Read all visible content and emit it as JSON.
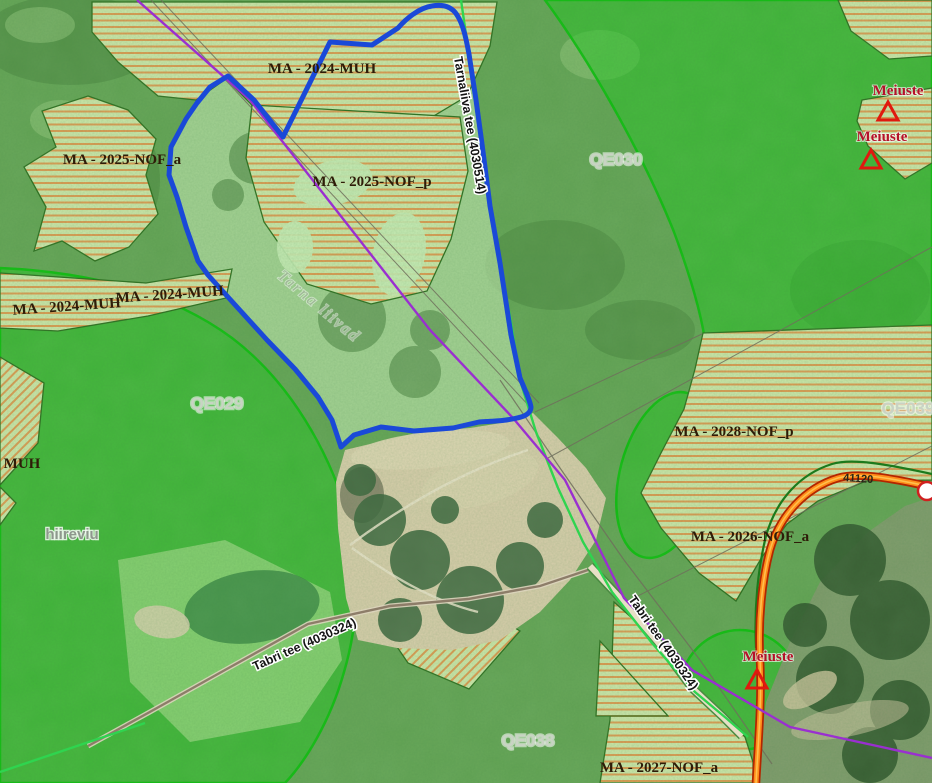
{
  "map": {
    "colors": {
      "boundary": "#1a49d8",
      "utility_line": "#9a2fd0",
      "protection_zone": "#0ebe0e",
      "hatch_stripe": "#de9b53",
      "hatch_base": "#cde6a9",
      "main_road": "#ff8c1a",
      "minor_road_green": "#2fd44f",
      "poi_red": "#e0190f"
    },
    "zone_labels": [
      {
        "text": "MA - 2024-MUH",
        "x": 322,
        "y": 73,
        "rot": 0
      },
      {
        "text": "MA - 2025-NOF_p",
        "x": 372,
        "y": 186,
        "rot": 0
      },
      {
        "text": "MA - 2025-NOF_a",
        "x": 122,
        "y": 164,
        "rot": 0
      },
      {
        "text": "MA - 2024-MUH",
        "x": 170,
        "y": 299,
        "rot": -4
      },
      {
        "text": "MA - 2024-MUH",
        "x": 67,
        "y": 311,
        "rot": -4
      },
      {
        "text": "MUH",
        "x": 22,
        "y": 468,
        "rot": 0
      },
      {
        "text": "MA - 2028-NOF_p",
        "x": 734,
        "y": 436,
        "rot": 0
      },
      {
        "text": "MA - 2026-NOF_a",
        "x": 750,
        "y": 541,
        "rot": 0
      },
      {
        "text": "MA - 2027-NOF_a",
        "x": 659,
        "y": 772,
        "rot": 0
      }
    ],
    "area_codes": [
      {
        "text": "QE029",
        "x": 217,
        "y": 409
      },
      {
        "text": "QE030",
        "x": 616,
        "y": 165
      },
      {
        "text": "QE038",
        "x": 528,
        "y": 746
      },
      {
        "text": "QE039",
        "x": 908,
        "y": 414
      }
    ],
    "place_labels": [
      {
        "text": "hiireviu",
        "x": 72,
        "y": 539
      }
    ],
    "terrain_labels": [
      {
        "text": "Tarna liivad",
        "x": 316,
        "y": 310,
        "rot": 40
      }
    ],
    "road_labels": [
      {
        "text": "Tarnaliiva tee (4030514)",
        "x": 466,
        "y": 126,
        "rot": 80
      },
      {
        "text": "Tabri tee (4030324)",
        "x": 306,
        "y": 648,
        "rot": -24
      },
      {
        "text": "Tabri tee (4030324)",
        "x": 660,
        "y": 645,
        "rot": 55
      }
    ],
    "poi_markers": [
      {
        "text": "Meiuste",
        "x": 898,
        "y": 95,
        "tx": 888,
        "ty": 112
      },
      {
        "text": "Meiuste",
        "x": 882,
        "y": 141,
        "tx": 871,
        "ty": 160
      },
      {
        "text": "Meiuste",
        "x": 768,
        "y": 661,
        "tx": 757,
        "ty": 680
      }
    ],
    "road_ref": {
      "text": "41120",
      "x": 858,
      "y": 482,
      "rot": 4
    }
  }
}
